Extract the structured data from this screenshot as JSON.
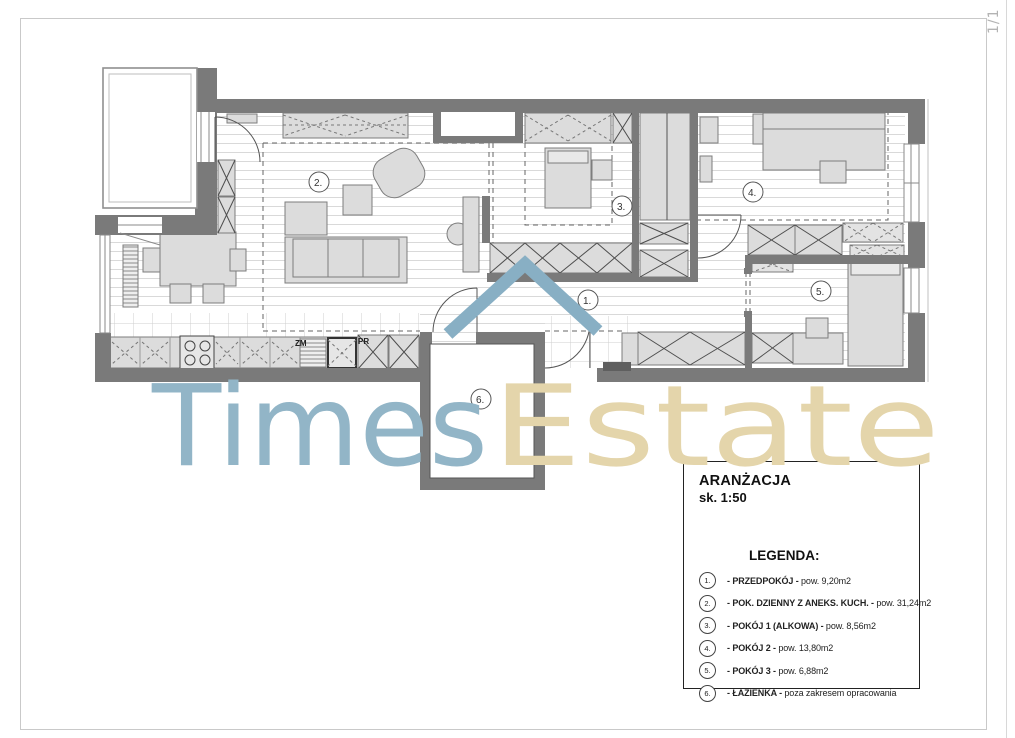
{
  "page": {
    "number": "1/1"
  },
  "watermark": {
    "part1": "Times",
    "part2": "Estate",
    "color_blue": "#92b5c7",
    "color_tan": "#e4d5ab",
    "roof_color": "#88afc4"
  },
  "plan": {
    "wall_color": "#7a7a7a",
    "furniture_fill": "#dcdcdc",
    "rooms": [
      {
        "num": "1."
      },
      {
        "num": "2."
      },
      {
        "num": "3."
      },
      {
        "num": "4."
      },
      {
        "num": "5."
      },
      {
        "num": "6."
      }
    ],
    "kitchen_labels": {
      "zm": "ZM",
      "pr": "PR"
    }
  },
  "legend": {
    "title": "ARANŻACJA",
    "scale": "sk. 1:50",
    "heading": "LEGENDA:",
    "items": [
      {
        "num": "1.",
        "pre": "- ",
        "name": "PRZEDPOKÓJ",
        "sep": " - ",
        "desc": "pow. 9,20m2"
      },
      {
        "num": "2.",
        "pre": "- ",
        "name": "POK. DZIENNY Z ANEKS. KUCH.",
        "sep": " - ",
        "desc": "pow. 31,24m2"
      },
      {
        "num": "3.",
        "pre": "- ",
        "name": "POKÓJ 1 (ALKOWA)",
        "sep": " - ",
        "desc": "pow. 8,56m2"
      },
      {
        "num": "4.",
        "pre": "- ",
        "name": "POKÓJ 2",
        "sep": " - ",
        "desc": "pow. 13,80m2"
      },
      {
        "num": "5.",
        "pre": "- ",
        "name": "POKÓJ 3",
        "sep": " - ",
        "desc": "pow. 6,88m2"
      },
      {
        "num": "6.",
        "pre": "- ",
        "name": "ŁAZIENKA",
        "sep": " - ",
        "desc": "poza zakresem opracowania"
      }
    ]
  }
}
